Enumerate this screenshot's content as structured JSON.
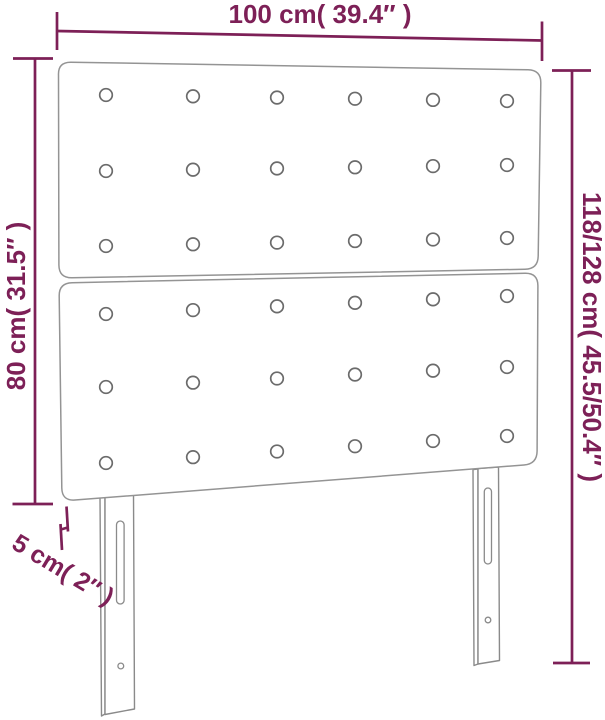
{
  "diagram": {
    "kind": "product-dimension-diagram",
    "product": "upholstered-headboard",
    "labels": {
      "width": "100 cm( 39.4″ )",
      "height_left": "80 cm( 31.5″ )",
      "height_right": "118/128 cm( 45.5/50.4″ )",
      "thickness": "5 cm( 2″ )"
    },
    "colors": {
      "dimension_accent": "#7d2057",
      "outline_gray": "#949494",
      "background": "#ffffff"
    },
    "structure": {
      "panels": 2,
      "button_rows_per_panel": 3,
      "button_cols": 6,
      "legs": 2
    }
  }
}
